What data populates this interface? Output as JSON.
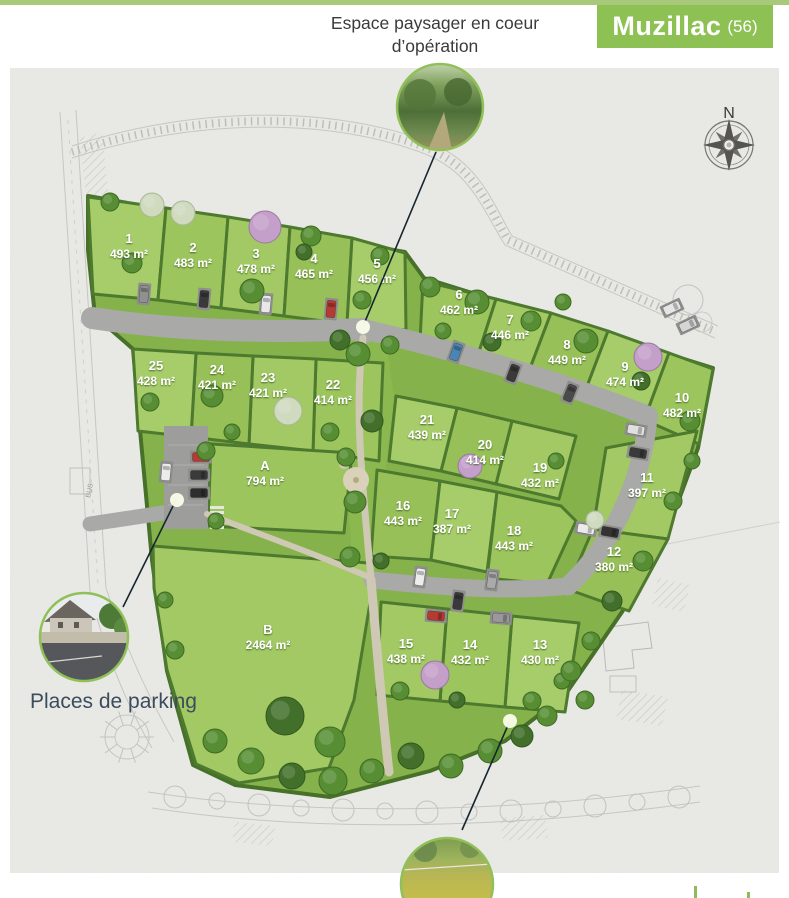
{
  "header": {
    "espace_line1": "Espace paysager en coeur",
    "espace_line2": "d’opération",
    "town": "Muzillac",
    "dept": "(56)"
  },
  "map": {
    "north_label": "N",
    "bus_label": "BUS",
    "parking_callout": "Places de parking",
    "lots": [
      {
        "id": "1",
        "area": "493 m²"
      },
      {
        "id": "2",
        "area": "483 m²"
      },
      {
        "id": "3",
        "area": "478 m²"
      },
      {
        "id": "4",
        "area": "465 m²"
      },
      {
        "id": "5",
        "area": "456 m²"
      },
      {
        "id": "6",
        "area": "462 m²"
      },
      {
        "id": "7",
        "area": "446 m²"
      },
      {
        "id": "8",
        "area": "449 m²"
      },
      {
        "id": "9",
        "area": "474 m²"
      },
      {
        "id": "10",
        "area": "482 m²"
      },
      {
        "id": "11",
        "area": "397 m²"
      },
      {
        "id": "12",
        "area": "380 m²"
      },
      {
        "id": "13",
        "area": "430 m²"
      },
      {
        "id": "14",
        "area": "432 m²"
      },
      {
        "id": "15",
        "area": "438 m²"
      },
      {
        "id": "16",
        "area": "443 m²"
      },
      {
        "id": "17",
        "area": "387 m²"
      },
      {
        "id": "18",
        "area": "443 m²"
      },
      {
        "id": "19",
        "area": "432 m²"
      },
      {
        "id": "20",
        "area": "414 m²"
      },
      {
        "id": "21",
        "area": "439 m²"
      },
      {
        "id": "22",
        "area": "414 m²"
      },
      {
        "id": "23",
        "area": "421 m²"
      },
      {
        "id": "24",
        "area": "421 m²"
      },
      {
        "id": "25",
        "area": "428 m²"
      },
      {
        "id": "A",
        "area": "794 m²"
      },
      {
        "id": "B",
        "area": "2464 m²"
      }
    ]
  },
  "colors": {
    "banner_green": "#8dc153",
    "top_bar_green": "#a8c87a",
    "hedge_green": "#4d7a2e",
    "grass_green": "#a0c862",
    "road_gray": "#a9a9a7",
    "paper_gray": "#eaeae7",
    "lot_label_text": "#ffffff",
    "callout_text": "#3c4c5c"
  }
}
